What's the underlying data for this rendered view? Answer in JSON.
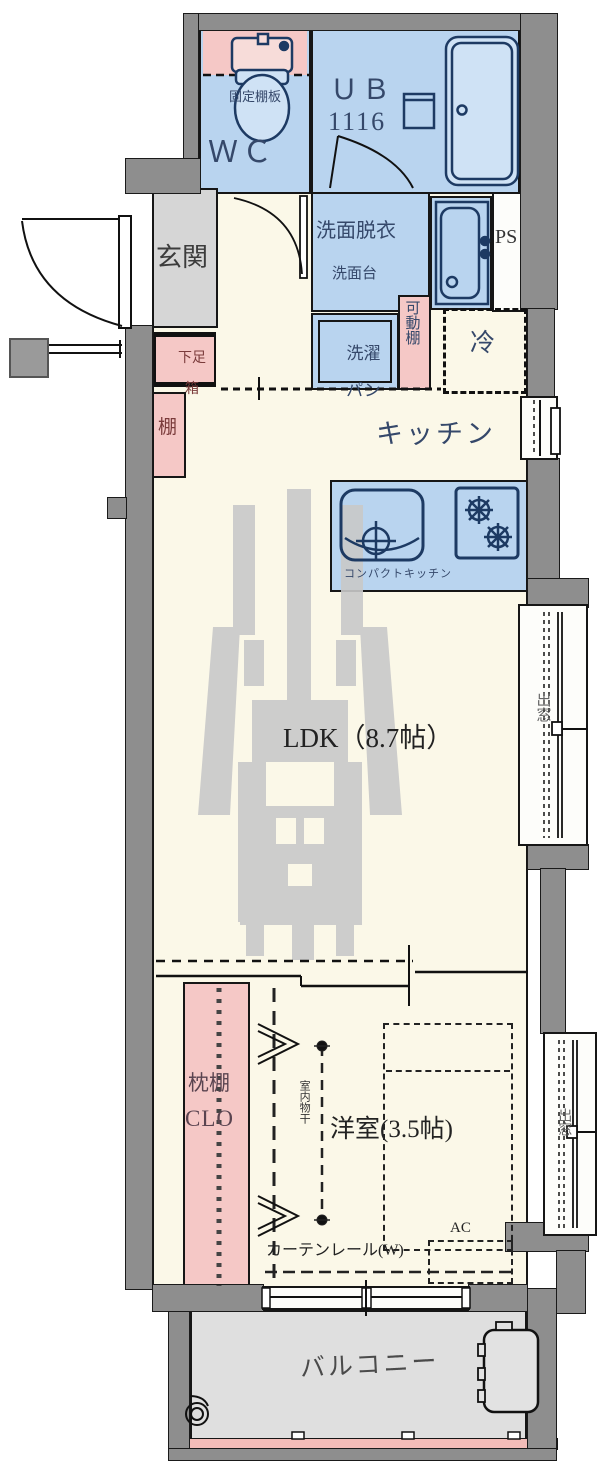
{
  "labels": {
    "fixed_shelf": "固定棚板",
    "wc": "ＷＣ",
    "ub": "ＵＢ",
    "ub_size": "1116",
    "entrance": "玄関",
    "washroom": "洗面脱衣",
    "vanity": "洗面台",
    "ps": "PS",
    "laundry_pan_line1": "洗濯",
    "laundry_pan_line2": "パン",
    "movable_shelf": "可動棚",
    "fridge": "冷",
    "shoe_box_line1": "下足",
    "shoe_box_line2": "箱",
    "shelf": "棚",
    "kitchen": "キッチン",
    "compact_kitchen": "コンパクトキッチン",
    "ldk": "LDK（8.7帖）",
    "bay_window_ldk": "出窓",
    "pillow_shelf": "枕棚",
    "closet": "CLO",
    "indoor_drying": "室内物干",
    "bedroom": "洋室(3.5帖)",
    "ac": "AC",
    "curtain_rail": "カーテンレール(W)",
    "bay_window_bedroom": "出窓",
    "balcony": "バルコニー"
  },
  "colors": {
    "wall": "#8e8e8e",
    "floor": "#fbf8e8",
    "wet_area_blue": "#b9d4ef",
    "shelf_pink": "#f5c8c6",
    "entry_gray": "#d6d6d6",
    "balcony_gray": "#dfdfdf",
    "railing_pink": "#f3bcb8",
    "fixture_line": "#1d3a63",
    "outline": "#161616",
    "watermark_gray": "#c9c9c9"
  }
}
